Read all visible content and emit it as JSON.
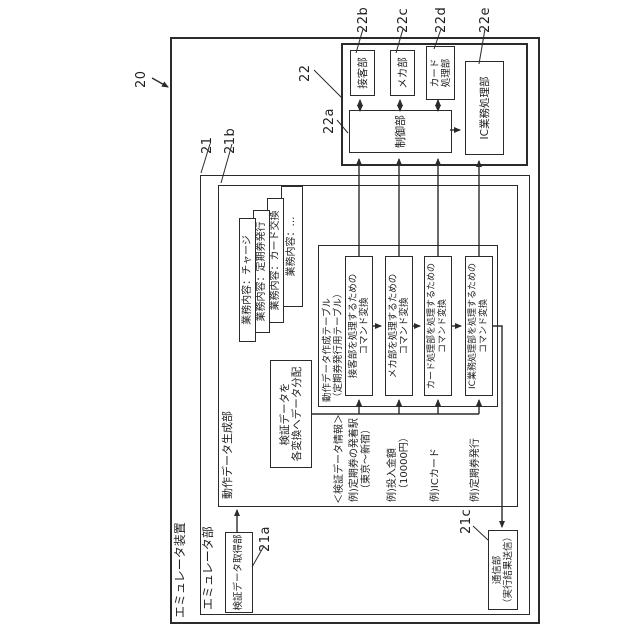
{
  "colors": {
    "background": "#ffffff",
    "line": "#2b2b2b"
  },
  "fig": {
    "device_title": "エミュレータ装置",
    "unit_title": "エミュレータ部",
    "generator_title": "動作データ生成部",
    "refs": {
      "r20": "20",
      "r21": "21",
      "r21a": "21a",
      "r21b": "21b",
      "r21c": "21c",
      "r22": "22",
      "r22a": "22a",
      "r22b": "22b",
      "r22c": "22c",
      "r22d": "22d",
      "r22e": "22e"
    },
    "cascade": [
      "業務内容：チャージ",
      "業務内容：定期券発行",
      "業務内容：カード交換",
      "業務内容：…"
    ],
    "dist": {
      "l1": "検証データを",
      "l2": "各変換へデータ分配"
    },
    "table": {
      "t1": "動作データ作成テーブル",
      "t2": "（定期券発行用テーブル）",
      "rows": [
        {
          "l1": "接客部を処理するための",
          "l2": "コマンド変換"
        },
        {
          "l1": "メカ部を処理するための",
          "l2": "コマンド変換"
        },
        {
          "l1": "カード処理部を処理するための",
          "l2": "コマンド変換"
        },
        {
          "l1": "IC業務処理部を処理するための",
          "l2": "コマンド変換"
        }
      ]
    },
    "unit22": {
      "reception": "接客部",
      "mechanism": "メカ部",
      "card1": "カード",
      "card2": "処理部",
      "control": "制御部",
      "ic": "IC業務処理部"
    },
    "acquisition": "検証データ取得部",
    "comm": {
      "l1": "通信部",
      "l2": "（実行結果送信）"
    },
    "ann": {
      "header": "＜検証データ情報＞",
      "a1": {
        "l1": "例)定期券の発着駅",
        "l2": "（東京～新宿）"
      },
      "a2": {
        "l1": "例)投入金額",
        "l2": "（10000円）"
      },
      "a3": "例)ICカード",
      "a4": "例)定期券発行"
    }
  }
}
